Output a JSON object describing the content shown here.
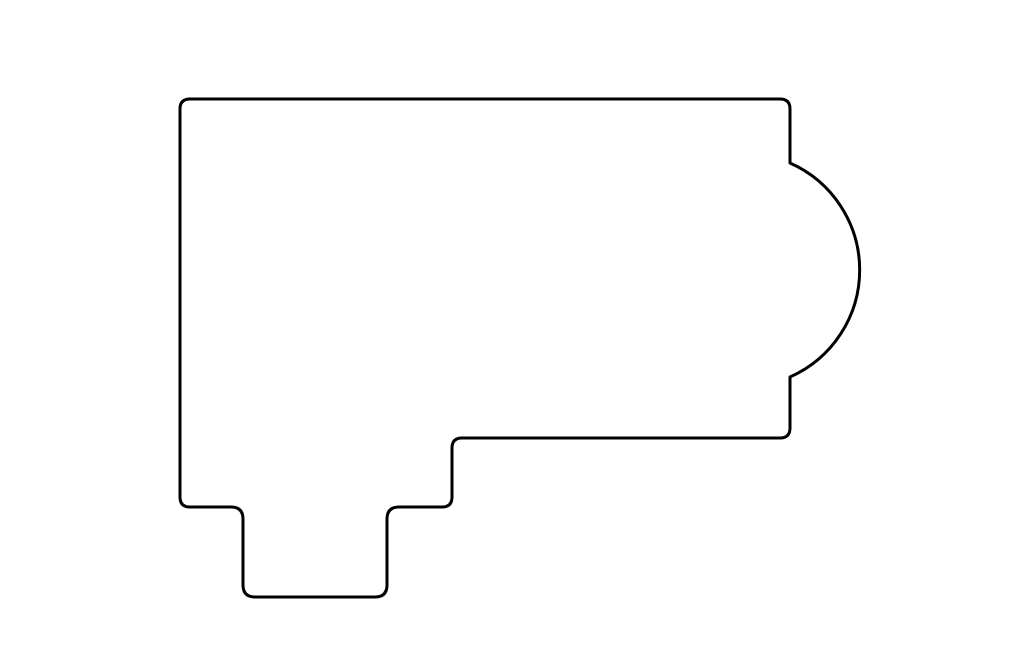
{
  "canvas": {
    "width": 1024,
    "height": 663,
    "background": "#ffffff"
  },
  "outline": {
    "stroke": "#000000",
    "stroke_width": 3,
    "fill": "#ffffff",
    "path": "M 190 99 L 780 99 Q 790 99 790 109 L 790 163 A 117 117 0 0 1 790 377 L 790 428 Q 790 438 780 438 L 462 438 Q 452 438 452 448 L 452 497 Q 452 507 442 507 L 399 507 Q 387 507 387 519 L 387 585 Q 387 597 375 597 L 255 597 Q 243 597 243 585 L 243 519 Q 243 507 231 507 L 190 507 Q 180 507 180 497 L 180 109 Q 180 99 190 99 Z"
  },
  "steps": {
    "stroke": "#888888",
    "stroke_width": 1,
    "lines": [
      {
        "x1": 243,
        "y1": 507.5,
        "x2": 387,
        "y2": 507.5
      },
      {
        "x1": 244,
        "y1": 530,
        "x2": 386,
        "y2": 530
      },
      {
        "x1": 244,
        "y1": 553,
        "x2": 386,
        "y2": 553
      },
      {
        "x1": 244,
        "y1": 575,
        "x2": 386,
        "y2": 575
      }
    ]
  }
}
